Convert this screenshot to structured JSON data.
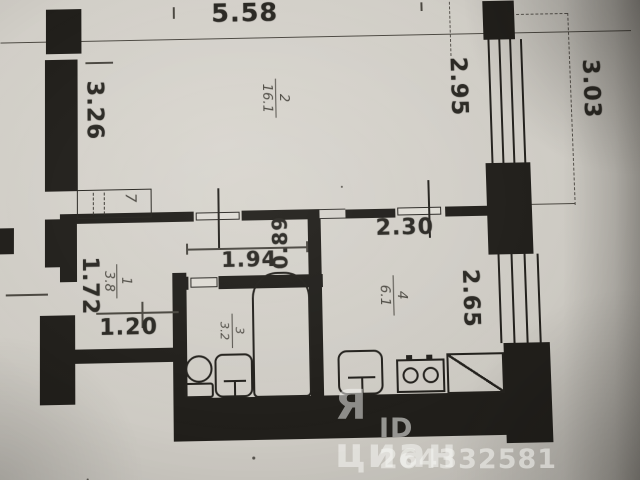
{
  "dimensions_m": {
    "top_overall": "5.58",
    "living_left": "3.26",
    "living_window": "2.95",
    "right_overall": "3.03",
    "kitchen_width": "2.30",
    "kitchen_depth": "2.65",
    "bath_corridor_width": "1.94",
    "corridor_depth": "0.89",
    "entry_side": "1.72",
    "hall_width": "1.20"
  },
  "rooms": {
    "living": {
      "number": "2",
      "area": "16.1"
    },
    "hallway": {
      "number": "1",
      "area": "3.8"
    },
    "bathroom": {
      "number": "3",
      "area": "3.2"
    },
    "kitchen": {
      "number": "4",
      "area": "6.1"
    },
    "closet": {
      "number": "7"
    }
  },
  "watermark": {
    "logo": "Я",
    "brand": "циан",
    "id": "ID 264332581"
  },
  "colors": {
    "ink": "#211f1b",
    "paper": "#d0cdc6",
    "watermark_text": "#fafaf7"
  }
}
